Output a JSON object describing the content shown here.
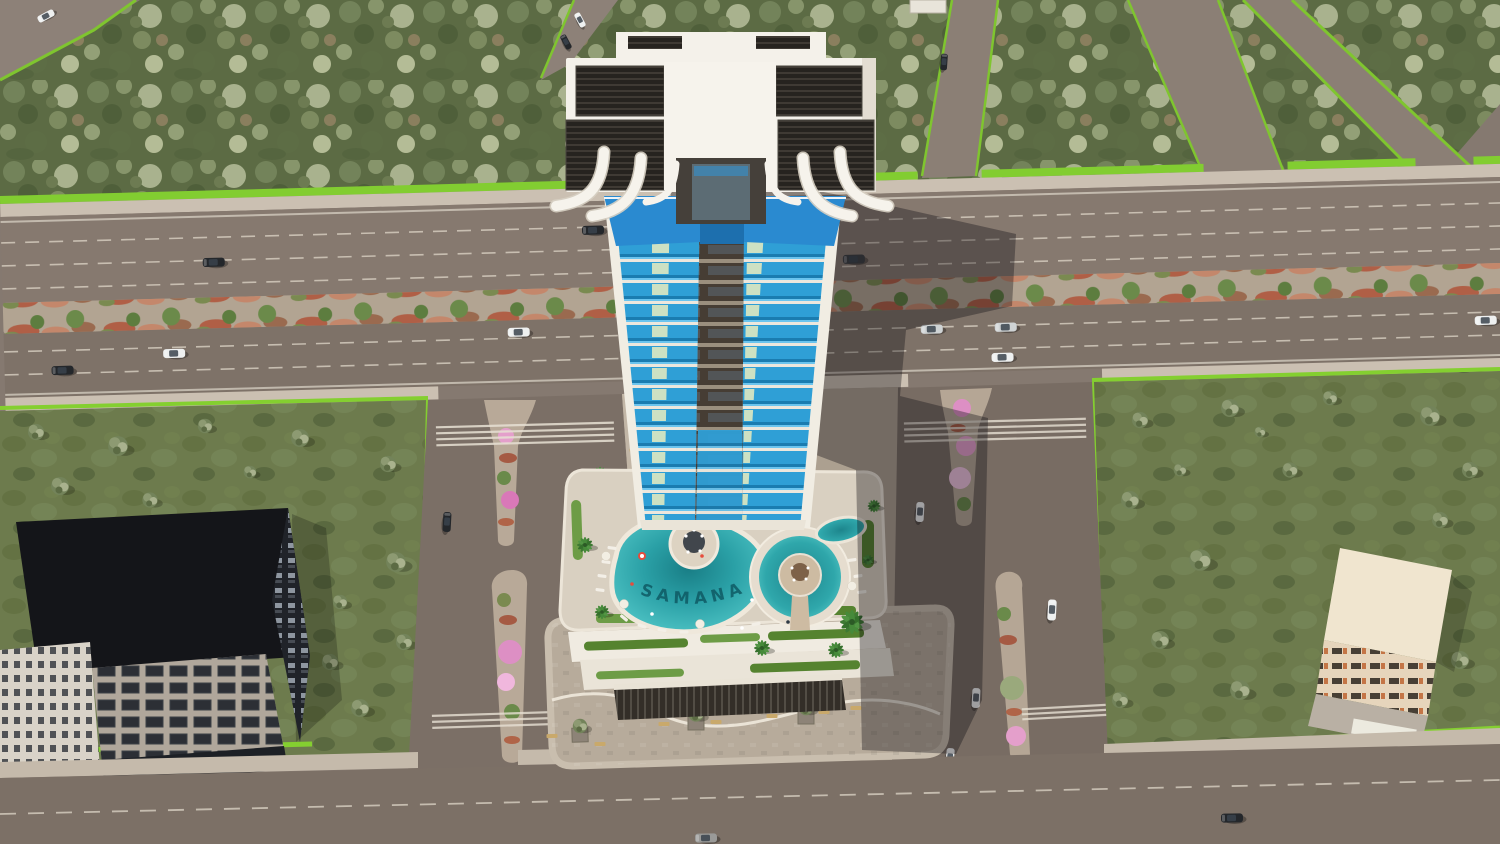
{
  "meta": {
    "title": "Aerial 3D architectural rendering of a high-rise residential tower with pool deck, surrounded by roads, forest and two neighboring buildings",
    "render_type": "photoreal-3d-aerial"
  },
  "branding": {
    "pool_text": "SAMANA"
  },
  "palette": {
    "base_road": "#857970",
    "highway_upper": "#86796f",
    "highway_lower": "#7e7268",
    "bottom_road": "#7c7066",
    "vertical_road": "#7b6f66",
    "sidewalk": "#c9beb0",
    "lane_marking": "#ded6c8",
    "hedge_green": "#84cf30",
    "forest_green": "#5c6b44",
    "grass_green": "#6d7b4d",
    "median_soil": "#b2a492",
    "shrub_red": "#b05f46",
    "blossom_pink": "#dd8fc4",
    "tower_white": "#f4f1ea",
    "balcony_blue": "#2f9fd6",
    "awning_blue": "#2a8ad0",
    "accent_yellow": "#e9ecc0",
    "core_brown": "#463d34",
    "pool_teal": "#2aa0a6",
    "deck_beige": "#d9d0c1",
    "plaza_paver": "#b7ab9b",
    "pergola_dark": "#332e28",
    "dark_building": "#141519",
    "beige_building": "#f0e5cf",
    "shadow": "rgba(17,15,20,0.36)",
    "car_white": "#eef0f0",
    "car_dark": "#24272b",
    "car_grey": "#9a9a98"
  }
}
